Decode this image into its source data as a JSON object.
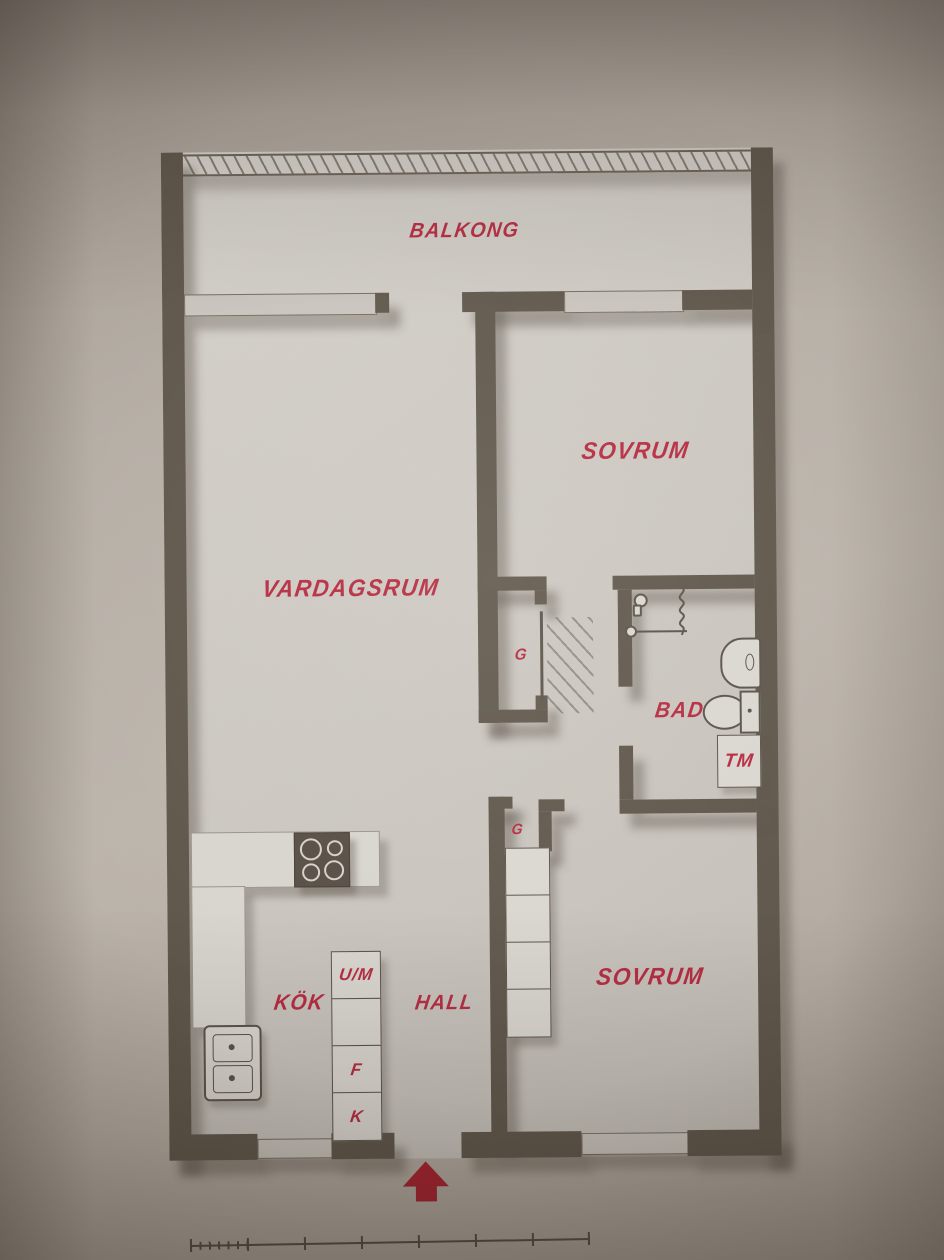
{
  "colors": {
    "label_red": "#b62a40",
    "arrow_red": "#a7212d",
    "wall": "#5f574b",
    "floor": "#ccc8c1",
    "paper": "#b2aaa0",
    "fixture_fill": "#dad6d0"
  },
  "rooms": {
    "balkong": "BALKONG",
    "sovrum_top": "SOVRUM",
    "vardagsrum": "VARDAGSRUM",
    "bad": "BAD",
    "kok": "KÖK",
    "hall": "HALL",
    "sovrum_bottom": "SOVRUM"
  },
  "fixtures": {
    "closet_mid": "G",
    "closet_bottom": "G",
    "washing_machine": "TM",
    "cabinet_top": "U/M",
    "cabinet_fridge": "F",
    "cabinet_freezer": "K"
  },
  "icons": [
    "balcony-railing",
    "stove-icon",
    "kitchen-sink-icon",
    "shower-icon",
    "shower-curtain-line",
    "washbasin-icon",
    "toilet-icon",
    "washing-machine-box",
    "entrance-arrow-icon",
    "scale-bar"
  ]
}
